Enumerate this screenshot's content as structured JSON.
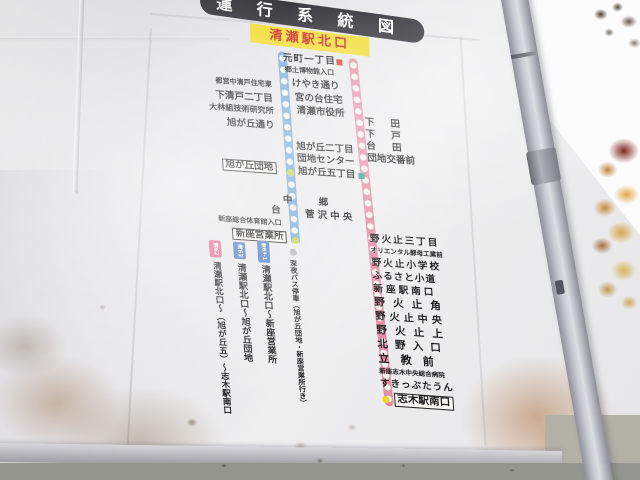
{
  "sign": {
    "title": "運行系統図",
    "origin_station": "清瀬駅北口",
    "colors": {
      "blue_route": "#74a9d8",
      "pink_route": "#e78ba6",
      "terminal_dot_green": "#c6d24c",
      "terminal_dot_yellow": "#f2d51f",
      "origin_bg": "#f2dc2e",
      "origin_text": "#cc2a1e",
      "banner_bg": "#2d2d33",
      "marker_red": "#d63a26",
      "marker_teal": "#2fa08c",
      "tag_pink": "#e0648c",
      "tag_blue": "#4a77c0",
      "night_bus_dot": "#b4b4b6"
    },
    "stops_shared": [
      "元町一丁目",
      "郷土博物館入口",
      "けやき通り",
      "宮の台住宅",
      "清瀬市役所"
    ],
    "stops_blue_left": [
      "都営中清戸住宅東",
      "下清戸二丁目",
      "大林組技術研究所",
      "旭が丘通り"
    ],
    "stops_blue_right": [
      "旭が丘二丁目",
      "団地センター",
      "旭が丘五丁目"
    ],
    "stop_asahigaoka_danchi": "旭が丘団地",
    "stops_blue_lower": [
      "台",
      "新座総合体育館入口"
    ],
    "terminal_blue": "新座営業所",
    "stops_pink_upper": [
      "下田",
      "下戸",
      "台田",
      "団地交番前"
    ],
    "stops_pink_mid": [
      "中郷",
      "菅沢中央"
    ],
    "stops_pink_lower": [
      "野火止三丁目",
      "オリエンタル酵母工業前",
      "野火止小学校",
      "ふるさと小道",
      "新座駅南口",
      "野火止角",
      "野火止中央",
      "野火止上",
      "北野入口",
      "立教前",
      "新座志木中央総合病院",
      "すきっぷたうん"
    ],
    "terminal_pink": "志木駅南口",
    "legend": {
      "routes": [
        {
          "tag": "清62",
          "dest": "清瀬駅北口～（旭が丘五）～志木駅南口"
        },
        {
          "tag": "清63",
          "dest": "清瀬駅北口～旭が丘団地"
        },
        {
          "tag": "清63-1",
          "dest": "清瀬駅北口～新座営業所"
        }
      ],
      "night_note": "深夜バス停車（旭が丘団地・新座営業所行き）"
    }
  }
}
